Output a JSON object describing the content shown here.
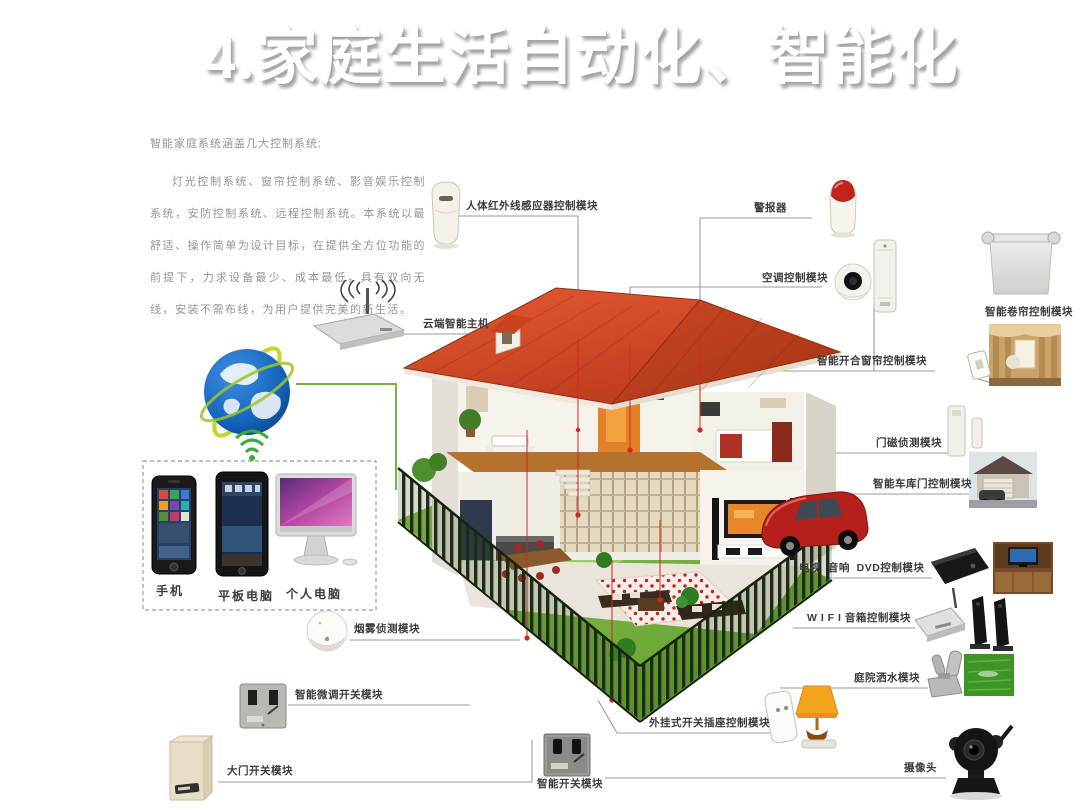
{
  "title": "4.家庭生活自动化、智能化",
  "intro": {
    "line1": "智能家庭系统涵盖几大控制系统:",
    "body": "灯光控制系统、窗帘控制系统、影音娱乐控制系统，安防控制系统、远程控制系统。本系统以最舒适、操作简单为设计目标，在提供全方位功能的前提下，力求设备最少、成本最低，具有双向无线，安装不需布线，为用户提供完美的新生活。"
  },
  "labels": {
    "pir": "人体红外线感应器控制模块",
    "alarm": "警报器",
    "ac": "空调控制模块",
    "roller": "智能卷帘控制模块",
    "curtain": "智能开合窗帘控制模块",
    "door_sensor": "门磁侦测模块",
    "garage": "智能车库门控制模块",
    "av": "电视  音响  DVD控制模块",
    "wifi_speaker": "W I F I 音箱控制模块",
    "sprinkler": "庭院洒水模块",
    "camera": "摄像头",
    "plug": "外挂式开关插座控制模块",
    "switch": "智能开关模块",
    "gate": "大门开关模块",
    "dimmer": "智能微调开关模块",
    "smoke": "烟雾侦测模块",
    "host": "云端智能主机",
    "phone": "手机",
    "tablet": "平板电脑",
    "pc": "个人电脑"
  },
  "colors": {
    "roof": "#d6502e",
    "lawn": "#7eb342",
    "red_line": "#cc2a1d",
    "connector": "#9b9b9b",
    "globe_blue": "#1565c0",
    "green_link": "#7cb342",
    "car": "#b6201a"
  }
}
